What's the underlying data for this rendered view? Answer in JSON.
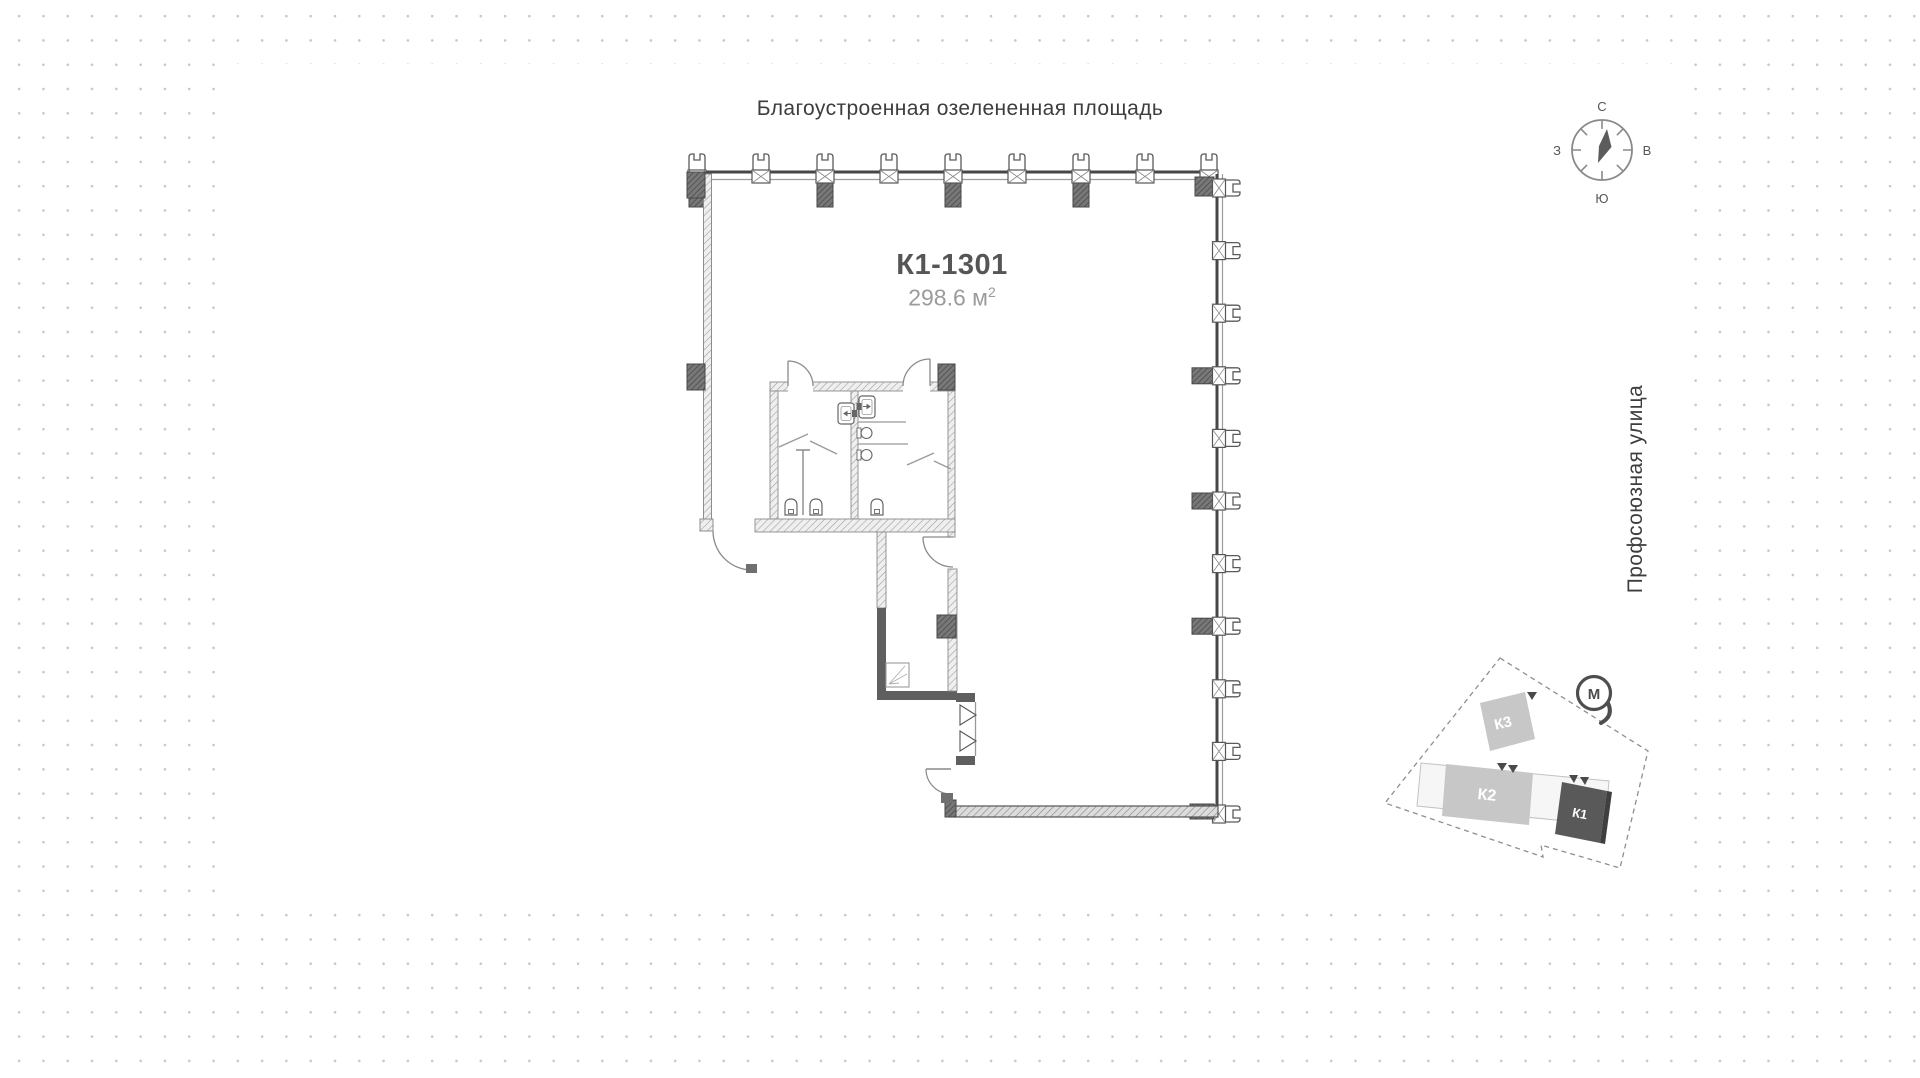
{
  "labels": {
    "top_area": "Благоустроенная озелененная площадь",
    "street": "Профсоюзная улица"
  },
  "unit": {
    "id": "К1-1301",
    "area": "298.6 м",
    "area_sup": "2"
  },
  "compass": {
    "north": "С",
    "east": "В",
    "south": "Ю",
    "west": "З"
  },
  "site_plan": {
    "buildings": [
      {
        "label": "К3"
      },
      {
        "label": "К2"
      },
      {
        "label": "К1"
      }
    ],
    "metro_label": "М"
  },
  "colors": {
    "wall_dark": "#4a4a4a",
    "wall_mid": "#5f5f5f",
    "hatch_line": "#a0a0a0",
    "text_dark": "#3d3d3d",
    "text_gray": "#9b9b9b",
    "dot_grid": "#c7c7c7",
    "building_light": "#c7c7c7",
    "building_dark": "#595959"
  }
}
